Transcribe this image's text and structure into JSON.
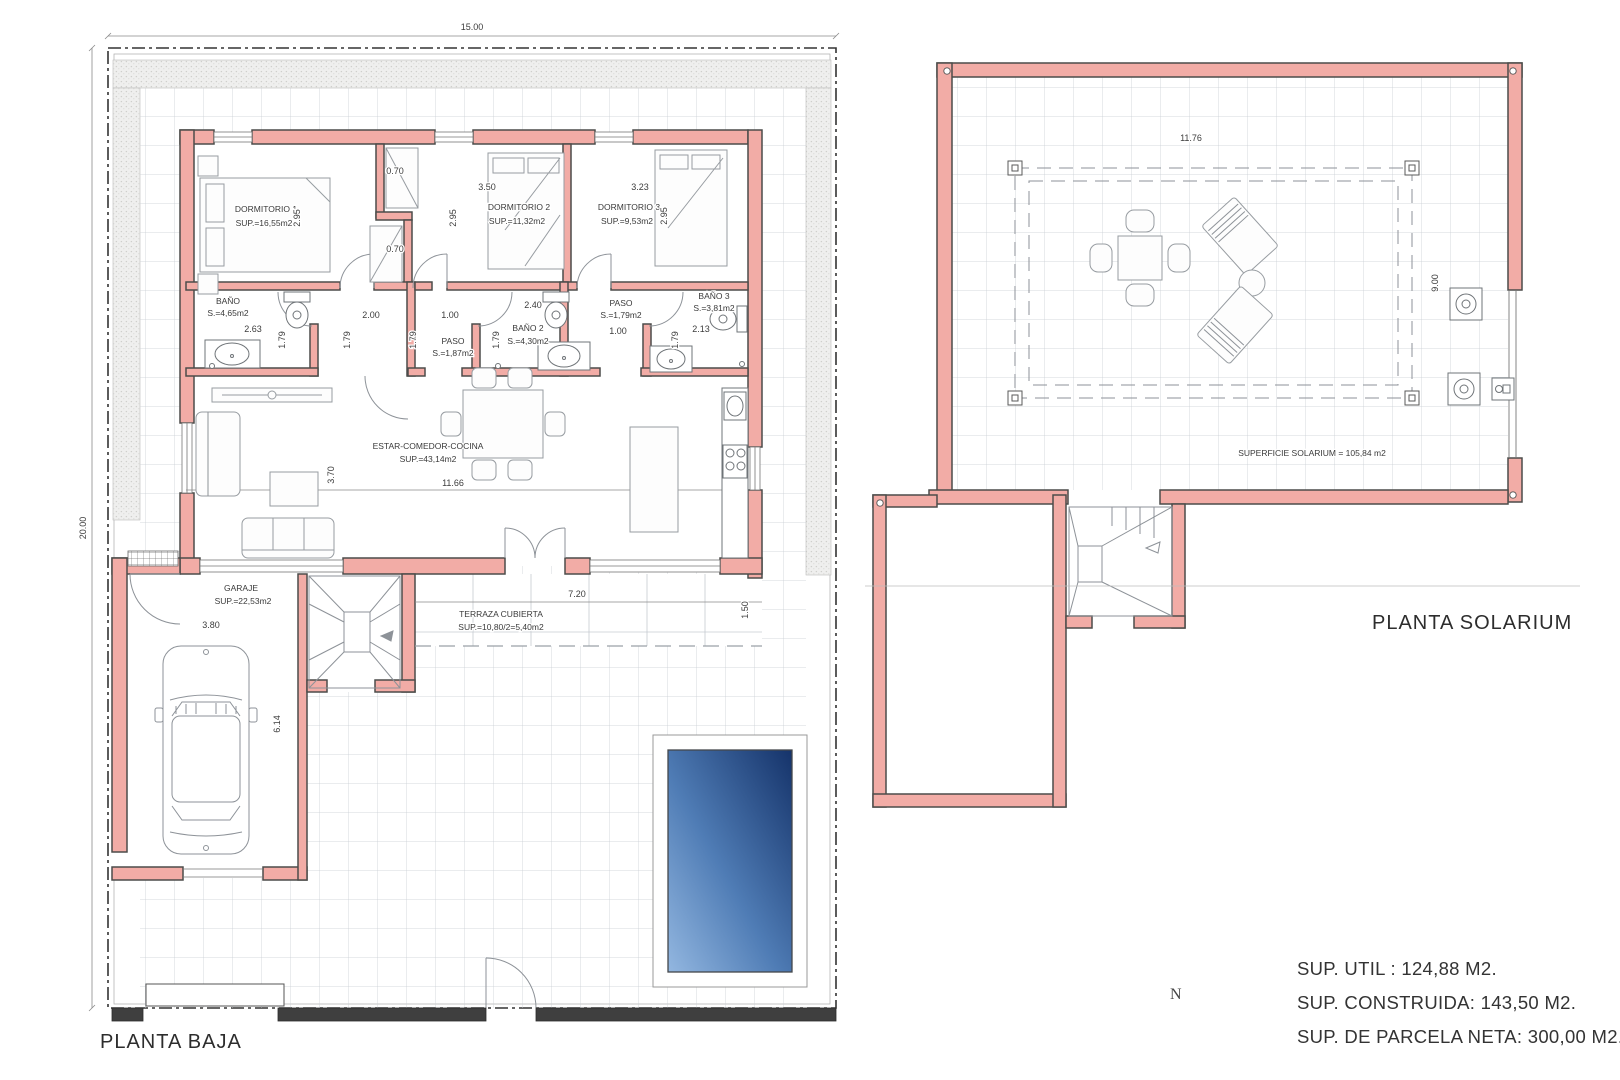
{
  "titles": {
    "ground": "PLANTA BAJA",
    "solarium": "PLANTA SOLARIUM"
  },
  "north_label": "N",
  "summary": {
    "util": "SUP. UTIL : 124,88 M2.",
    "construida": "SUP. CONSTRUIDA: 143,50 M2.",
    "parcela": "SUP. DE PARCELA NETA: 300,00 M2."
  },
  "parcel": {
    "width": "15.00",
    "height": "20.00"
  },
  "ground": {
    "rooms": {
      "dorm1": {
        "name": "DORMITORIO 1",
        "area": "SUP.=16,55m2"
      },
      "dorm2": {
        "name": "DORMITORIO 2",
        "area": "SUP.=11,32m2"
      },
      "dorm3": {
        "name": "DORMITORIO 3",
        "area": "SUP.=9,53m2"
      },
      "bano1": {
        "name": "BAÑO",
        "area": "S.=4,65m2"
      },
      "bano2": {
        "name": "BAÑO 2",
        "area": "S.=4,30m2"
      },
      "bano3": {
        "name": "BAÑO 3",
        "area": "S.=3,81m2"
      },
      "paso1": {
        "name": "PASO",
        "area": "S.=1,87m2"
      },
      "paso2": {
        "name": "PASO",
        "area": "S.=1,79m2"
      },
      "estar": {
        "name": "ESTAR-COMEDOR-COCINA",
        "area": "SUP.=43,14m2"
      },
      "garaje": {
        "name": "GARAJE",
        "area": "SUP.=22,53m2"
      },
      "terraza": {
        "name": "TERRAZA CUBIERTA",
        "area": "SUP.=10,80/2=5,40m2"
      }
    },
    "dims": {
      "d070": "0.70",
      "d295": "2.95",
      "d350": "3.50",
      "d323": "3.23",
      "d263": "2.63",
      "d179": "1.79",
      "d200": "2.00",
      "d100": "1.00",
      "d240": "2.40",
      "d213": "2.13",
      "d1166": "11.66",
      "d370": "3.70",
      "d380": "3.80",
      "d614": "6.14",
      "d720": "7.20",
      "d150": "1.50"
    }
  },
  "solarium": {
    "label": "SUPERFICIE SOLARIUM = 105,84 m2",
    "dims": {
      "w": "11.76",
      "h": "9.00"
    }
  },
  "colors": {
    "wall_fill": "#F2ACA6",
    "wall_stroke": "#4c4c4a",
    "pool_light": "#93b7e0",
    "pool_dark": "#15336a"
  }
}
